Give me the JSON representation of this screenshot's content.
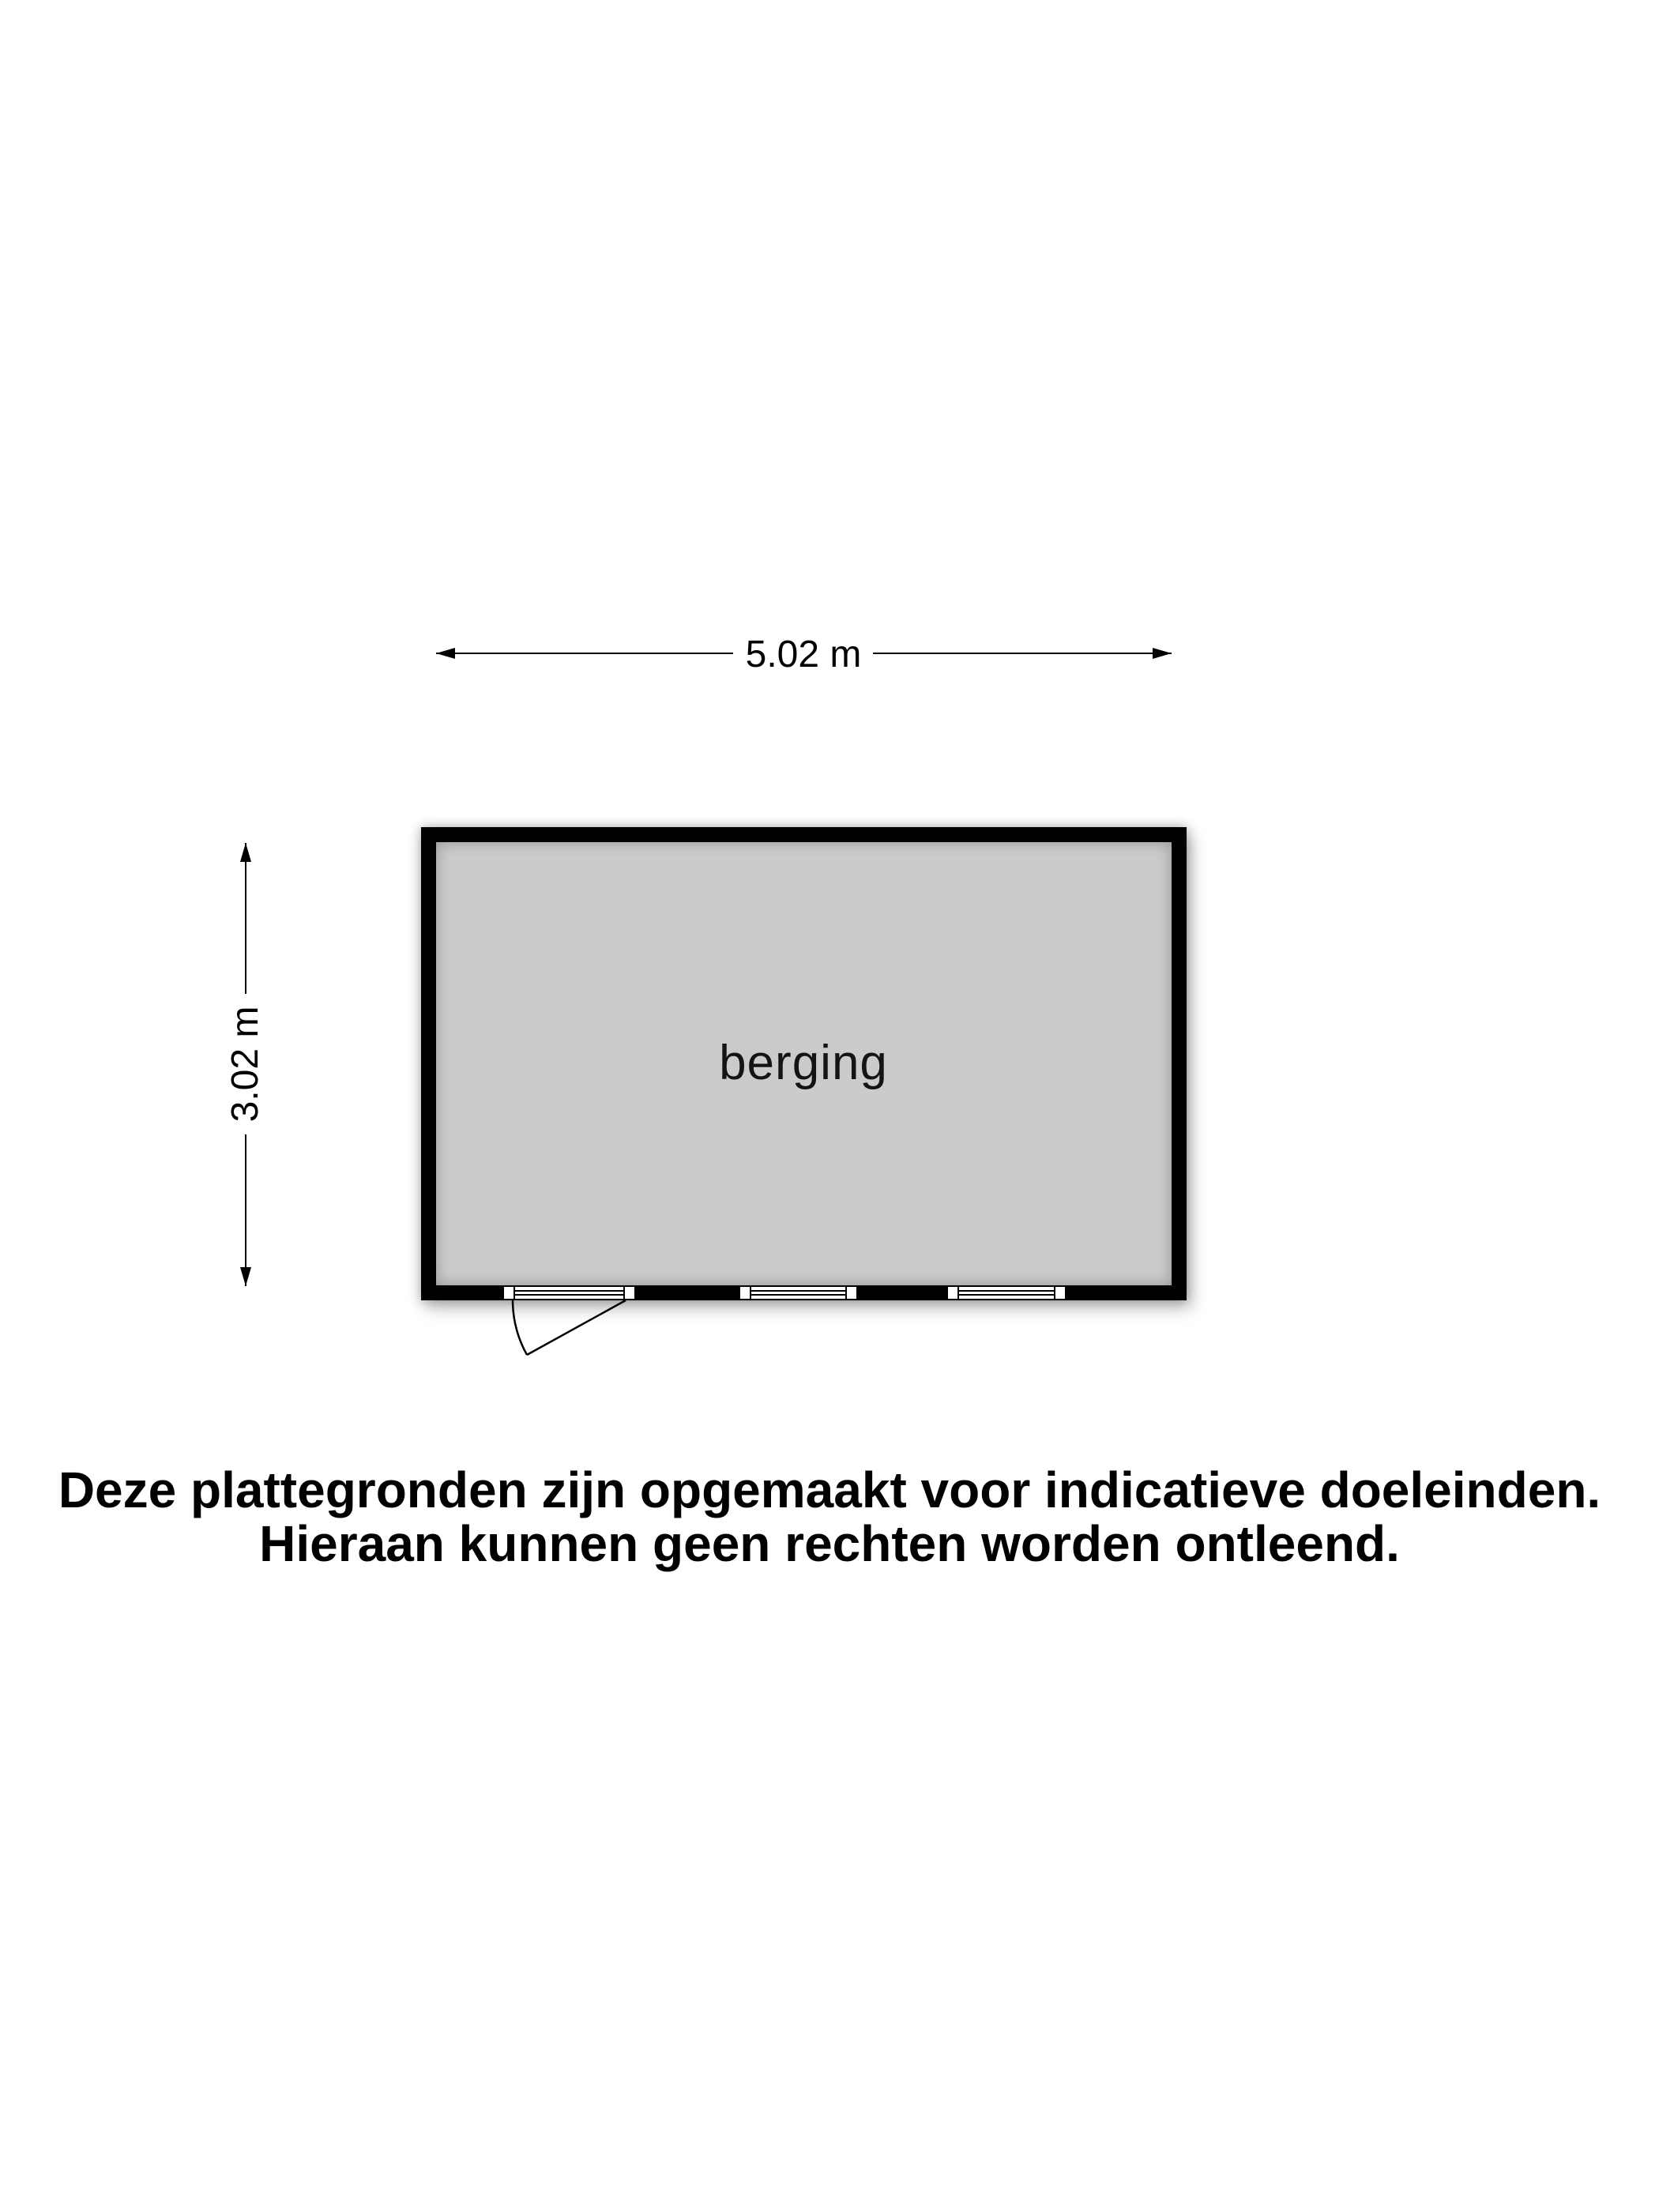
{
  "floor_plan": {
    "room": {
      "label": "berging"
    },
    "dimensions": {
      "width_label": "5.02 m",
      "height_label": "3.02 m"
    }
  },
  "disclaimer": {
    "line1": "Deze plattegronden zijn opgemaakt voor indicatieve doeleinden.",
    "line2": "Hieraan kunnen geen rechten worden ontleend."
  },
  "colors": {
    "wall": "#000000",
    "floor": "#cbcbcb",
    "background": "#ffffff",
    "text": "#000000"
  }
}
